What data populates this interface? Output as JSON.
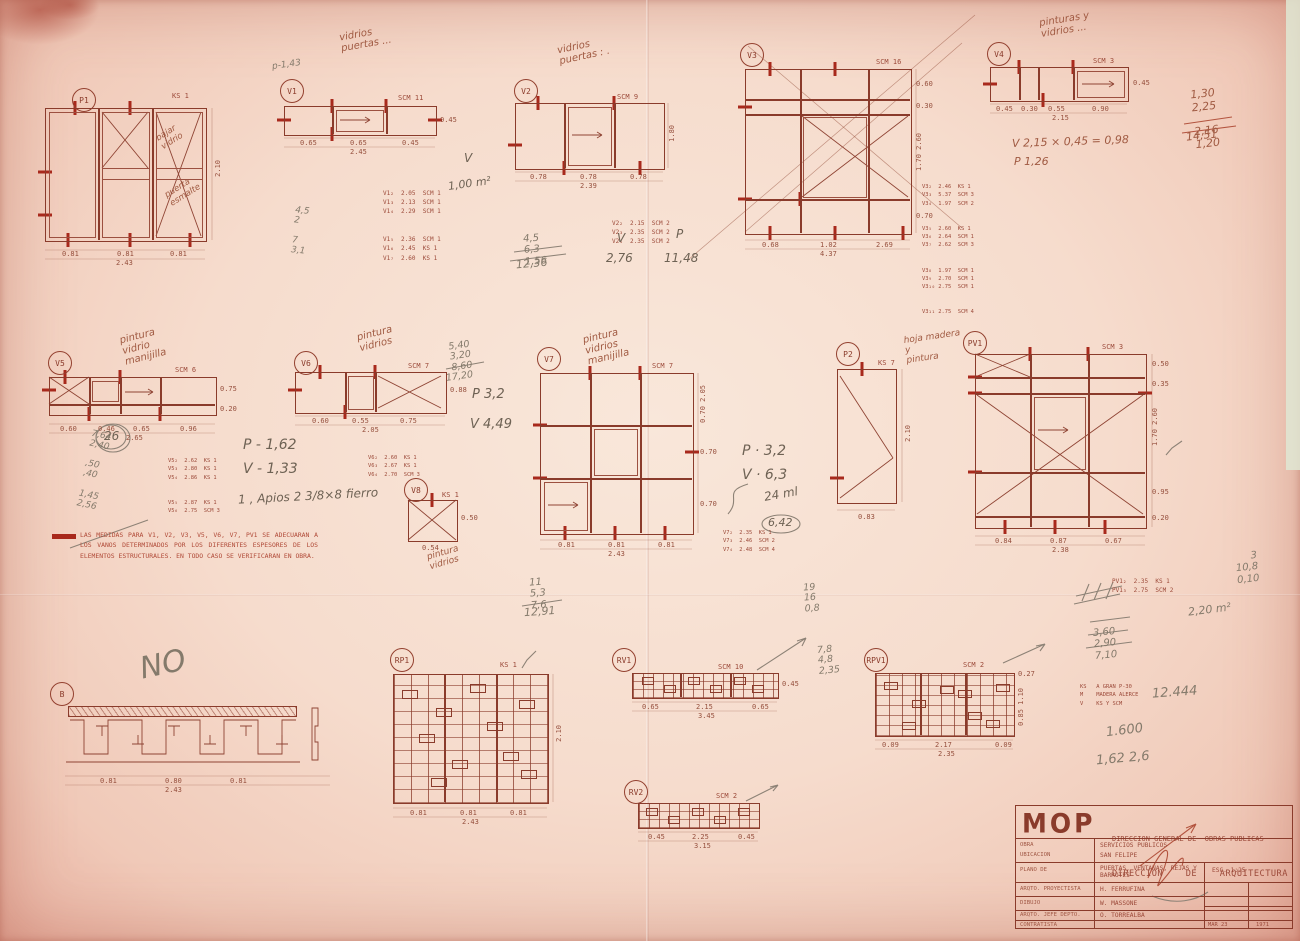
{
  "sheet": {
    "logo": "MOP",
    "org_line1": "DIRECCION GENERAL DE  OBRAS PUBLICAS",
    "org_line2": "DIRECCION    DE    ARQUITECTURA"
  },
  "titleblock": {
    "obra_label": "OBRA",
    "obra_value": "SERVICIOS PUBLICOS",
    "ubicacion_label": "UBICACION",
    "ubicacion_value": "SAN FELIPE",
    "plano_label": "PLANO DE",
    "plano_value": "PUERTAS, VENTANAS, REJAS Y\nBARROTES",
    "esc_value": "ESC. 1:25",
    "proyectista_label": "ARQTO. PROYECTISTA",
    "proyectista_value": "H. FERRUFINA",
    "dibujo_label": "DIBUJO",
    "dibujo_value": "W. MASSONE",
    "jefe_label": "ARQTO. JEFE DEPTO.",
    "jefe_value": "O. TORREALBA",
    "contratista_label": "CONTRATISTA",
    "fecha_mes": "MAR 23",
    "fecha_ano": "1971"
  },
  "note": {
    "text": "LAS MEDIDAS PARA V1, V2, V3, V5, V6, V7, PV1 SE ADECUARAN A LOS VANOS DETERMINADOS POR LOS DIFERENTES ESPESORES DE LOS ELEMENTOS ESTRUCTURALES. EN TODO CASO SE VERIFICARAN EN OBRA."
  },
  "figures": {
    "p1": {
      "label": "P1",
      "tag": "KS 1",
      "dim_h": "2.10",
      "w1": "0.81",
      "w2": "0.81",
      "w3": "0.81",
      "total": "2.43"
    },
    "v1": {
      "label": "V1",
      "tag": "SCM 11",
      "dim_h": "0.45",
      "w1": "0.65",
      "w2": "0.65",
      "w3": "0.45",
      "total": "2.45"
    },
    "v2": {
      "label": "V2",
      "tag": "SCM 9",
      "dim_h": "1.80",
      "w1": "0.78",
      "w2": "0.78",
      "w3": "0.78",
      "total": "2.39"
    },
    "v3": {
      "label": "V3",
      "tag": "SCM 16",
      "r1": "0.60",
      "r2": "0.30",
      "r3": "1.70 2.60",
      "r4": "0.70",
      "w1": "0.68",
      "w2": "1.02",
      "w3": "2.69",
      "total": "4.37"
    },
    "v4": {
      "label": "V4",
      "tag": "SCM 3",
      "dim_h": "0.45",
      "w1": "0.45",
      "w2": "0.30",
      "w3": "0.55",
      "w4": "0.90",
      "total": "2.15"
    },
    "v5": {
      "label": "V5",
      "tag": "SCM 6",
      "r1": "0.75",
      "r2": "0.20",
      "w1": "0.60",
      "w2": "0.46",
      "w3": "0.65",
      "w4": "0.96",
      "total": "2.65"
    },
    "v6": {
      "label": "V6",
      "tag": "SCM 7",
      "dim_h": "0.88",
      "w1": "0.60",
      "w2": "0.55",
      "w3": "0.75",
      "total": "2.05"
    },
    "v7": {
      "label": "V7",
      "tag": "SCM 7",
      "r1": "0.70 2.05",
      "r2": "0.70",
      "r3": "0.70",
      "w1": "0.81",
      "w2": "0.81",
      "w3": "0.81",
      "total": "2.43"
    },
    "v8": {
      "label": "V8",
      "tag": "KS 1",
      "dim_h": "0.50",
      "w1": "0.54"
    },
    "p2": {
      "label": "P2",
      "tag": "KS 7",
      "dim_h": "2.10",
      "w1": "0.83"
    },
    "pv1": {
      "label": "PV1",
      "tag": "SCM 3",
      "r1": "0.50",
      "r2": "0.35",
      "r3": "1.70 2.60",
      "r4": "0.95",
      "r5": "0.20",
      "w1": "0.84",
      "w2": "0.87",
      "w3": "0.67",
      "total": "2.38"
    },
    "b": {
      "label": "B",
      "w1": "0.81",
      "w2": "0.80",
      "w3": "0.81",
      "total": "2.43"
    },
    "rp1": {
      "label": "RP1",
      "tag": "KS 1",
      "dim_h": "2.10",
      "w1": "0.81",
      "w2": "0.81",
      "w3": "0.81",
      "total": "2.43"
    },
    "rv1": {
      "label": "RV1",
      "tag": "SCM 10",
      "dim_h": "0.45",
      "w1": "0.65",
      "w2": "2.15",
      "w3": "0.65",
      "total": "3.45"
    },
    "rpv1": {
      "label": "RPV1",
      "tag": "SCM 2",
      "r1": "0.27",
      "r2": "0.85 1.10",
      "w1": "0.09",
      "w2": "2.17",
      "w3": "0.09",
      "total": "2.35"
    },
    "rv2": {
      "label": "RV2",
      "tag": "SCM 2",
      "dim_h": "0.40",
      "w1": "0.45",
      "w2": "2.25",
      "w3": "0.45",
      "total": "3.15"
    }
  },
  "tables": {
    "v1": [
      "V1₂  2.05  SCM 1",
      "V1₃  2.13  SCM 1",
      "V1₄  2.29  SCM 1",
      "V1₅  2.36  SCM 1",
      "V1₆  2.45  KS 1",
      "V1₇  2.60  KS 1"
    ],
    "v2": [
      "V2₂  2.15  SCM 2",
      "V2₃  2.35  SCM 2",
      "V2₄  2.35  SCM 2"
    ],
    "v3": [
      "V3₂  2.46  KS 1",
      "V3₃  5.37  SCM 3",
      "V3₄  1.97  SCM 2",
      "V3₅  2.60  KS 1",
      "V3₆  2.64  SCM 1",
      "V3₇  2.62  SCM 3",
      "V3₈  1.97  SCM 1",
      "V3₉  2.70  SCM 1",
      "V3₁₀ 2.75  SCM 1",
      "V3₁₁ 2.75  SCM 4"
    ],
    "v5": [
      "V5₂  2.62  KS 1",
      "V5₃  2.80  KS 1",
      "V5₄  2.86  KS 1",
      "V5₅  2.87  KS 1",
      "V5₆  2.75  SCM 3"
    ],
    "v6": [
      "V6₂  2.60  KS 1",
      "V6₃  2.67  KS 1",
      "V6₄  2.70  SCM 3"
    ],
    "v7": [
      "V7₂  2.35  KS 1",
      "V7₃  2.46  SCM 2",
      "V7₄  2.48  SCM 4"
    ],
    "pv1": [
      "PV1₂  2.35  KS 1",
      "PV1₃  2.75  SCM 2"
    ]
  },
  "legend": [
    "KS   A GRAN P-30",
    "M    MADERA ALERCE",
    "V    KS Y SCM"
  ],
  "annotations": {
    "top_v1": "vidrios\npuertas ...",
    "top_v2": "vidrios\npuertas : .",
    "top_v4": "pinturas y\nvidrios ...",
    "p143": "p-1,43",
    "v1_col": [
      "4,5",
      "2",
      "7",
      "3,1"
    ],
    "v1_v": "V",
    "v1_val": "1,00  m²",
    "v2_col": [
      "4,5",
      "6,3",
      "1,56"
    ],
    "v2_tot": "12,36",
    "v2_v": "V",
    "v2_vval": "2,76",
    "v2_p": "P",
    "v2_pval": "11,48",
    "v4_col": [
      "1,30",
      "2,25",
      "2,16",
      "1,20"
    ],
    "v4_tot": "14,51",
    "v4_v": "V    2,15 × 0,45 = 0,98",
    "v4_p": "P    1,26",
    "v5_top": "pintura\nvidrio\nmanijilla",
    "v5_col": [
      "7,64",
      "2,40",
      ",50",
      ",40",
      "1,45",
      "2,56"
    ],
    "c26": "26",
    "v5_p": "P - 1,62",
    "v5_v": "V - 1,33",
    "apios": "1 , Apios 2  3/8×8 fierro",
    "v6_top": "pintura\nvidrios",
    "v6_col": [
      "5,40",
      "3,20",
      "8,60"
    ],
    "v6_tot": "17,20",
    "v6_p": "P  3,2",
    "v6_v": "V  4,49",
    "v8_note": "pintura\nvidrios",
    "v7_top": "pintura\nvidrios\nmanijilla",
    "v7_col": [
      "11",
      "5,3",
      "7,6"
    ],
    "v7_tot": "12,91",
    "v7_right": [
      "19",
      "16",
      "0,8"
    ],
    "c642": "6,42",
    "p2_top": "hoja madera\ny\npintura",
    "p2_p": "P · 3,2",
    "p2_v": "V · 6,3",
    "p2_x": "24 ml",
    "no": "NO",
    "p1_a": "bajar\nvidrio",
    "p1_b": "puerta\nesmalte",
    "rv1_col": [
      "7,8",
      "4,8",
      "2,35"
    ],
    "right_col": [
      "3",
      "10,8",
      "0,10"
    ],
    "m2": "2,20 m²",
    "sum2": [
      "3,60",
      "2,90",
      "7,10"
    ],
    "big1": "12.444",
    "big2": "1.600",
    "big3": "1,62   2,6"
  }
}
